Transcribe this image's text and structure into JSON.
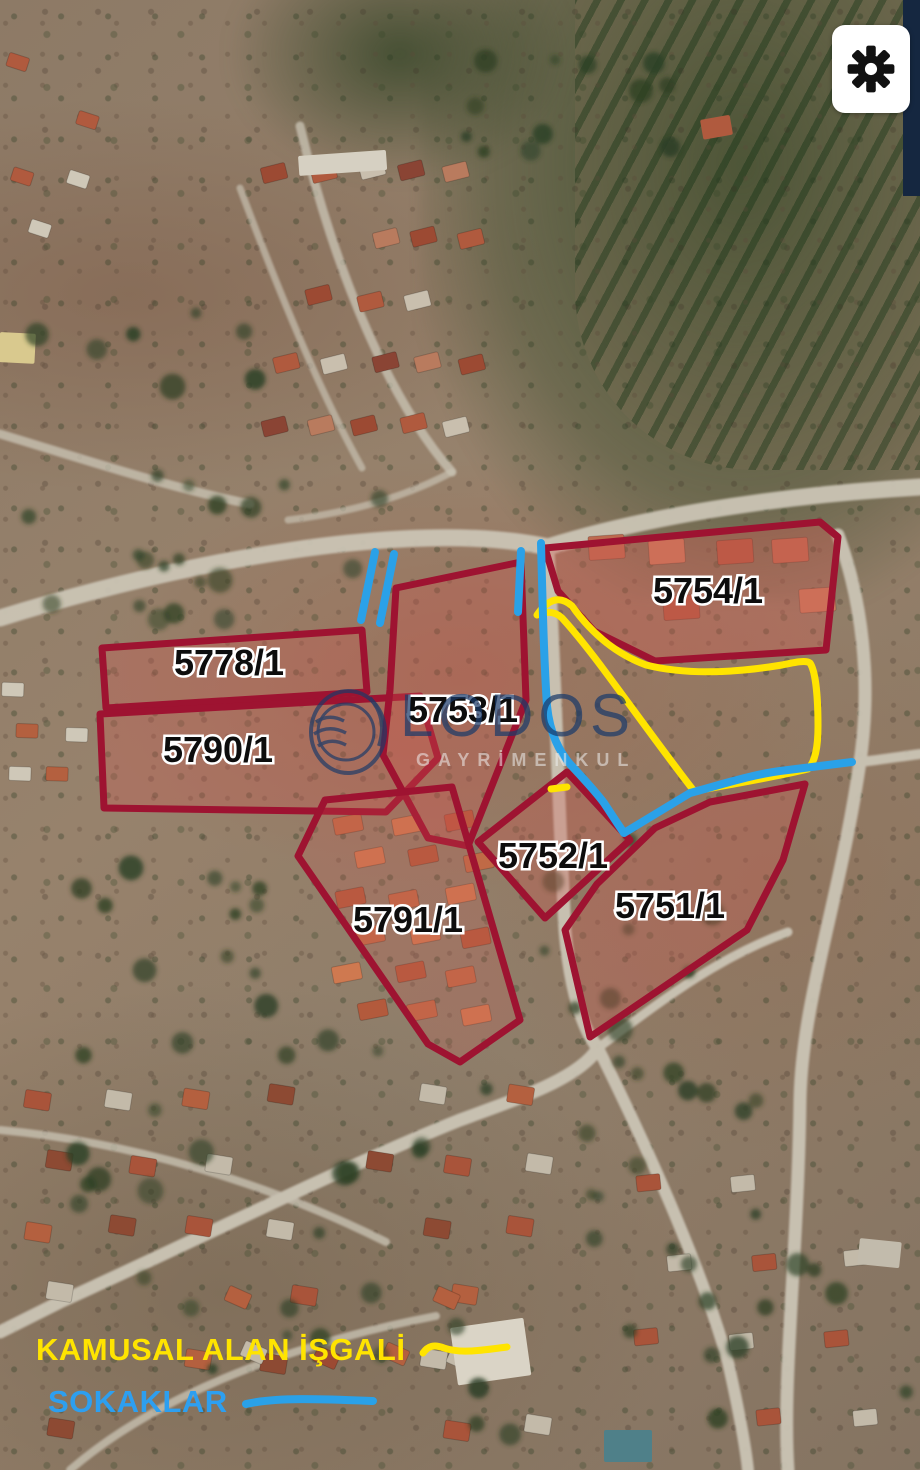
{
  "map": {
    "kind": "satellite cadastral overlay",
    "parcels": [
      {
        "id": "5754/1"
      },
      {
        "id": "5778/1"
      },
      {
        "id": "5790/1"
      },
      {
        "id": "5753/1"
      },
      {
        "id": "5752/1"
      },
      {
        "id": "5751/1"
      },
      {
        "id": "5791/1"
      }
    ]
  },
  "legend": [
    {
      "label": "KAMUSAL ALAN İŞGALİ",
      "color": "#FFE400"
    },
    {
      "label": "SOKAKLAR",
      "color": "#2D9FF0"
    }
  ],
  "watermark": {
    "name": "LODOS",
    "subtitle": "GAYRİMENKUL"
  },
  "toolbar": {
    "settings_icon": "gear"
  },
  "colors": {
    "parcel_outline": "#9E1331",
    "parcel_fill": "rgba(210,85,80,0.30)",
    "public_area_line": "#FFE400",
    "street_line": "#2AA1E8",
    "panel": "#FFFFFF",
    "gear": "#111111",
    "edge_strip": "#152740"
  }
}
